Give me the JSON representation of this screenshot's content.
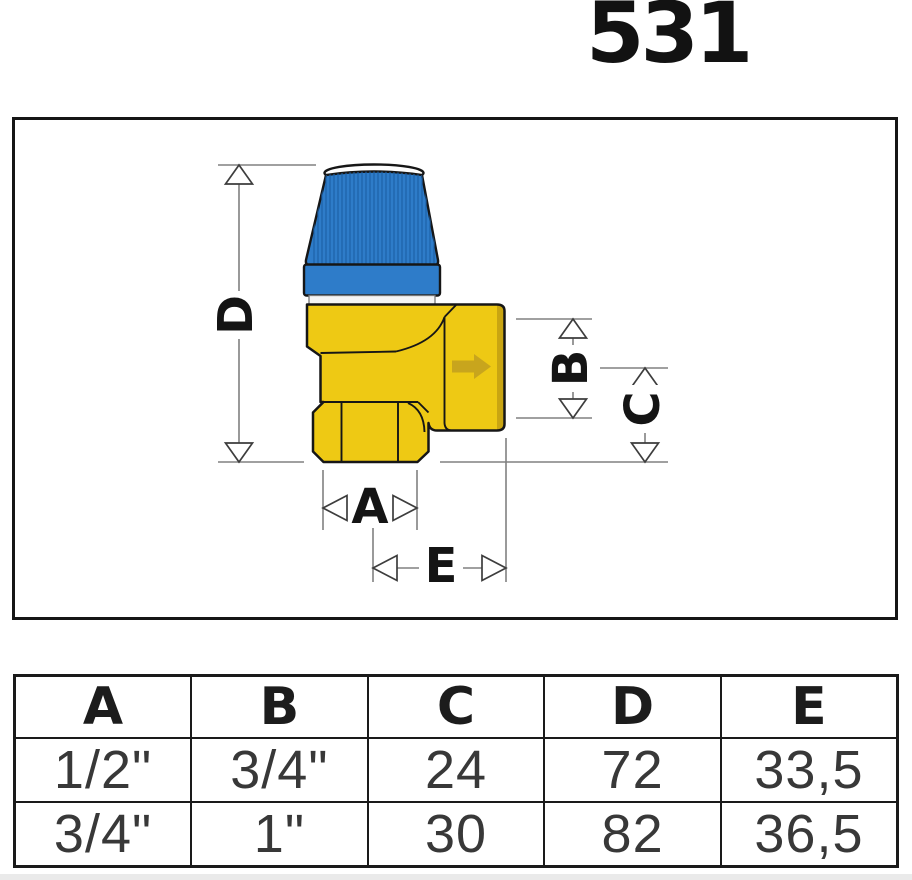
{
  "product_code": "531",
  "diagram": {
    "dim_labels": {
      "A": "A",
      "B": "B",
      "C": "C",
      "D": "D",
      "E": "E"
    },
    "flow_arrow_icon": "right-arrow",
    "colors": {
      "cap_blue": "#2e7cc9",
      "cap_rib_blue": "#1d61a8",
      "body_yellow": "#eec914",
      "body_shade_yellow": "#c9a512",
      "flow_arrow_yellow": "#c8a51d",
      "outline_black": "#161616",
      "dimension_gray": "#808080"
    }
  },
  "table": {
    "headers": [
      "A",
      "B",
      "C",
      "D",
      "E"
    ],
    "rows": [
      [
        "1/2\"",
        "3/4\"",
        "24",
        "72",
        "33,5"
      ],
      [
        "3/4\"",
        "1\"",
        "30",
        "82",
        "36,5"
      ]
    ]
  }
}
